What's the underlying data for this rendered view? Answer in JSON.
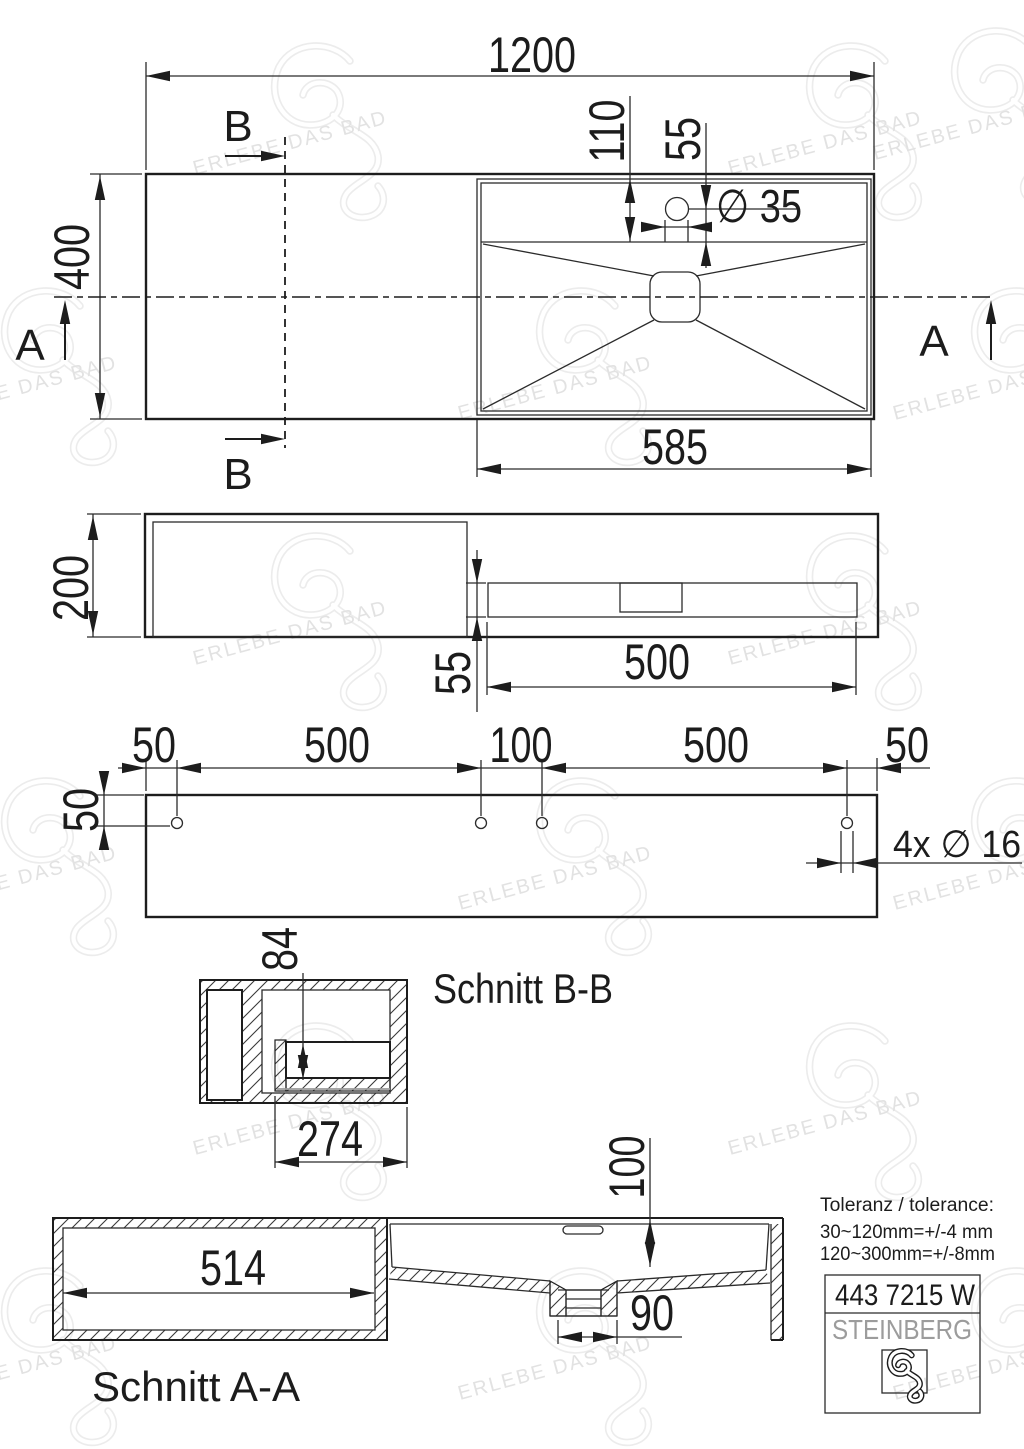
{
  "drawing": {
    "watermark": {
      "glyph": "brand-swirl",
      "text": "ERLEBE DAS BAD"
    },
    "colors": {
      "line": "#1d1d1d",
      "brand_gray": "#9c9c9c",
      "watermark": "#ececec",
      "background": "#ffffff"
    },
    "top_view": {
      "dim_width": "1200",
      "dim_height": "400",
      "dim_basin_width": "585",
      "dim_faucet_depth": "110",
      "dim_faucet_center": "55",
      "dim_faucet_hole": "∅ 35",
      "section_b": "B",
      "section_a": "A"
    },
    "front_view": {
      "dim_height": "200",
      "dim_basin_height": "55",
      "dim_basin_length": "500"
    },
    "rear_view": {
      "dims_top": [
        "50",
        "500",
        "100",
        "500",
        "50"
      ],
      "dim_side": "50",
      "holes_label": "4x ∅ 16"
    },
    "section_bb": {
      "title": "Schnitt B-B",
      "dim_depth": "84",
      "dim_width": "274"
    },
    "section_aa": {
      "title": "Schnitt A-A",
      "dim_inner": "514",
      "dim_depth": "100",
      "dim_drain": "90"
    },
    "tolerance": {
      "line1": "Toleranz / tolerance:",
      "line2": "30~120mm=+/-4  mm",
      "line3": "120~300mm=+/-8mm"
    },
    "title_block": {
      "model": "443 7215 W",
      "brand": "STEINBERG"
    }
  }
}
